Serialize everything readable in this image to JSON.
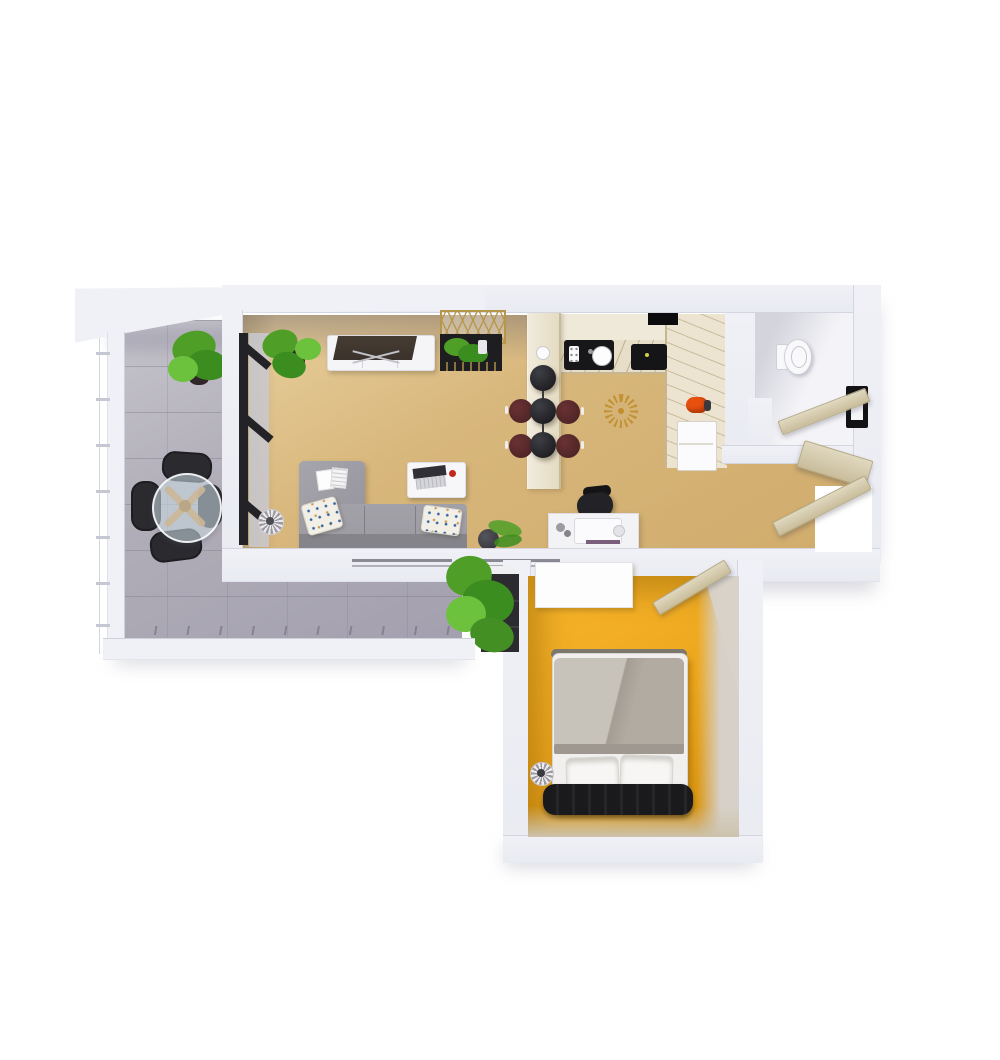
{
  "scene": {
    "description": "3D rendered top-down floor plan of a one-bedroom apartment with balcony",
    "rooms": [
      {
        "id": "balcony",
        "items": [
          "glass-dining-table",
          "dining-chair x4",
          "potted-plant",
          "railing"
        ]
      },
      {
        "id": "living-room",
        "items": [
          "tv-console",
          "tv",
          "display-shelf",
          "sectional-sofa",
          "throw-pillow x2",
          "magazine",
          "coffee-table",
          "laptop",
          "floor-lamp",
          "potted-plant",
          "fern-pot",
          "desk",
          "office-chair",
          "desk-machine"
        ]
      },
      {
        "id": "kitchen",
        "items": [
          "bar-counter",
          "pendant-lamp x3",
          "bar-stool x4",
          "sink",
          "cooktop",
          "range-hood",
          "refrigerator",
          "kettle",
          "sunburst-decor",
          "counter-l-shape"
        ]
      },
      {
        "id": "bathroom",
        "items": [
          "toilet",
          "bathroom-door",
          "bathroom-window"
        ]
      },
      {
        "id": "hallway",
        "items": [
          "entry-door",
          "entry-console",
          "doorway-opening"
        ]
      },
      {
        "id": "bedroom",
        "items": [
          "double-bed",
          "duvet",
          "bed-pillow x2",
          "headboard",
          "bedside-lamp",
          "dresser",
          "bedroom-door",
          "plant-shelf"
        ]
      }
    ],
    "palette": {
      "wall": "#f0f1f6",
      "wallEdge": "#d3d5df",
      "wallFace": "#e7e8ee",
      "glassTrack": "#c9c9d1",
      "balconyFloor": "#b0adb8",
      "balconyLine": "#8f8b9b",
      "livingFloor": "#d8b77c",
      "livingFloorLight": "#e8cf9c",
      "counter": "#ece4d0",
      "counterEdge": "#c6b691",
      "barTop": "#efe9d9",
      "bathFloor": "#f4f4f8",
      "bedroomFloor": "#eda71e",
      "doorLeaf": "#e0d8c0",
      "doorLeafDark": "#c9bd9b",
      "doorEdge": "#b5aa85",
      "sofa": "#9b9aa1",
      "sofaDark": "#85848b",
      "pillowBase": "#f2efe7",
      "pillowBlue": "#34639e",
      "pillowTan": "#c79b53",
      "tvDark": "#3a322b",
      "consoleWhite": "#f5f5f7",
      "shelfGold": "#b5964a",
      "shelfBox": "#1e1d20",
      "plantDark": "#3c8d1f",
      "plantMid": "#4f9e28",
      "plantLight": "#6cc13d",
      "potDark": "#302528",
      "pendant": "#1c1c20",
      "stool": "#542a2c",
      "glass": "rgba(198,213,222,0.6)",
      "woodLeg": "#cbb796",
      "deskWhite": "#f3f3f6",
      "chairBlack": "#232327",
      "bedSheet": "#f1f0ee",
      "duvet": "#b2aba1",
      "duvetLight": "#c7c2ba",
      "bedPillow": "#f7f6f4",
      "headboard": "#1a191c",
      "bedEdge": "#7c786e",
      "toiletWhite": "#f9f9fb",
      "sunburst": "#c08f2c",
      "kettle": "#e8500f",
      "windowDark": "#131316",
      "lampStripe": "#9b99a0",
      "fridge": "#fbfbfd",
      "shadow": "rgba(168,168,184,0.45)"
    }
  }
}
